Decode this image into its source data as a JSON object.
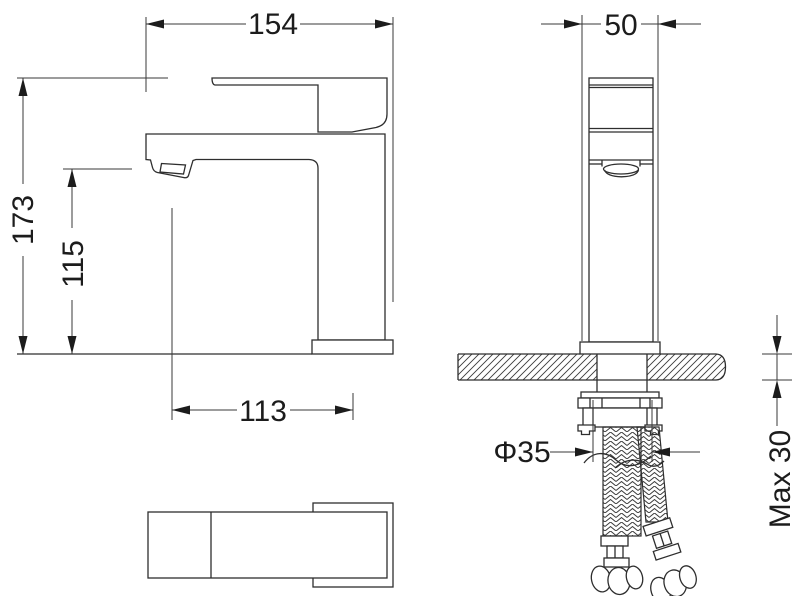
{
  "title": "Basin mixer tap dimensional drawing",
  "dimensions": {
    "total_depth": "154",
    "body_width": "50",
    "total_height": "173",
    "spout_height": "115",
    "spout_reach": "113",
    "hole_diameter": "Φ35",
    "max_counter_thickness": "Max 30"
  },
  "colors": {
    "line": "#2e2e2e",
    "dimension_line": "#3a3a3a",
    "text": "#1c1c1c",
    "background": "#ffffff"
  }
}
